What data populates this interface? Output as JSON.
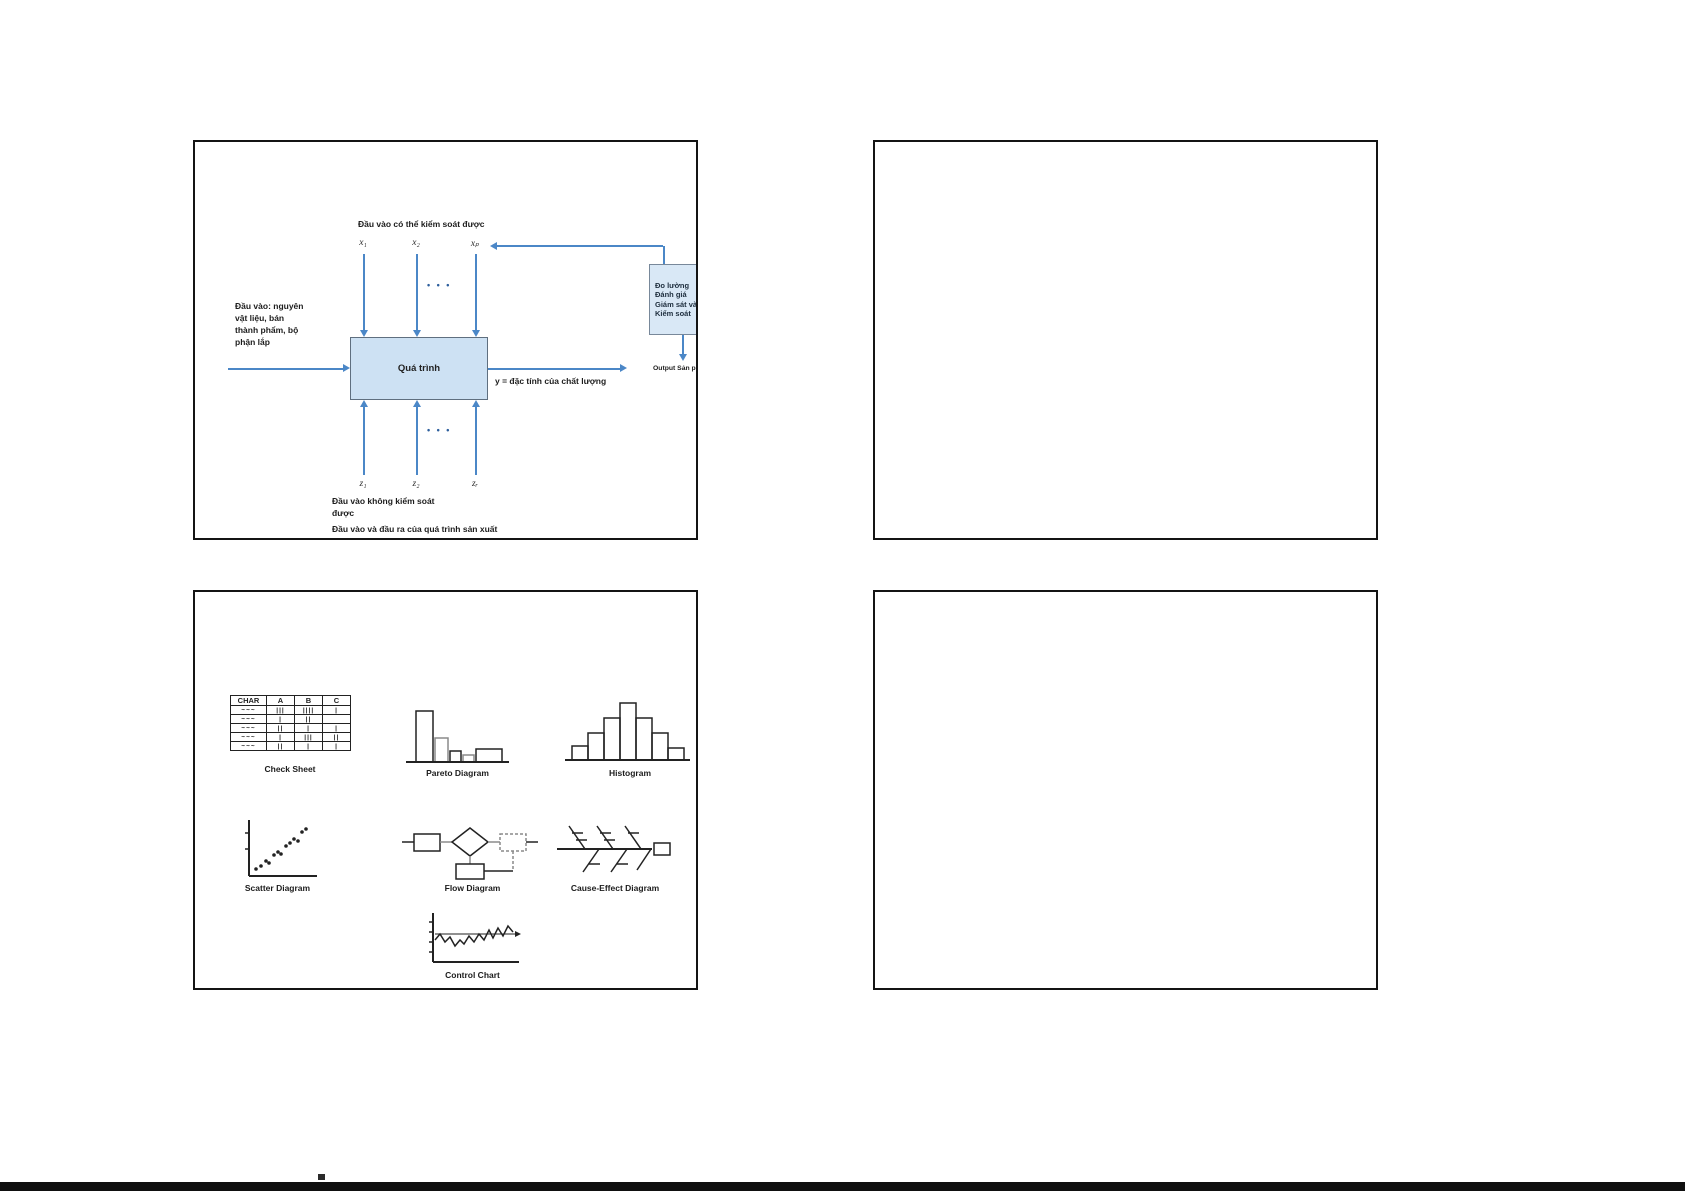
{
  "page": {
    "background": "#ffffff",
    "footer_bar_color": "#0f0f0f"
  },
  "slides": {
    "process": {
      "top_label": "Đầu vào có thể kiểm soát được",
      "x_vars": [
        "x₁",
        "x₂",
        "xₚ"
      ],
      "dots": "• • •",
      "input_lines": [
        "Đầu vào: nguyên",
        "vật liệu, bán",
        "thành phẩm, bộ",
        "phận lắp"
      ],
      "process_label": "Quá trình",
      "y_label": "y = đặc tính của chất lượng",
      "measure_lines": [
        "Đo lường",
        "Đánh giá",
        "Giám sát và",
        "Kiểm soát"
      ],
      "output_label": "Output Sản phẩm",
      "z_vars": [
        "z₁",
        "z₂",
        "zᵣ"
      ],
      "uncontrolled_lines": [
        "Đầu vào không kiểm soát",
        "được"
      ],
      "caption": "Đầu vào và đầu ra của quá trình sản xuất",
      "colors": {
        "arrow": "#4b87c7",
        "process_fill": "#cde1f3",
        "measure_fill": "#d9e8f6"
      }
    },
    "tools": {
      "check_sheet": {
        "label": "Check Sheet",
        "headers": [
          "CHAR",
          "A",
          "B",
          "C"
        ],
        "rows": [
          [
            "~~~",
            "|||",
            "||||",
            "|"
          ],
          [
            "~~~",
            "|",
            "||",
            ""
          ],
          [
            "~~~",
            "||",
            "|",
            "|"
          ],
          [
            "~~~",
            "|",
            "|||",
            "||"
          ],
          [
            "~~~",
            "||",
            "|",
            "|"
          ]
        ]
      },
      "pareto": {
        "label": "Pareto Diagram"
      },
      "histogram": {
        "label": "Histogram"
      },
      "scatter": {
        "label": "Scatter Diagram"
      },
      "flow": {
        "label": "Flow Diagram"
      },
      "fishbone": {
        "label": "Cause-Effect Diagram"
      },
      "control": {
        "label": "Control Chart"
      }
    }
  }
}
